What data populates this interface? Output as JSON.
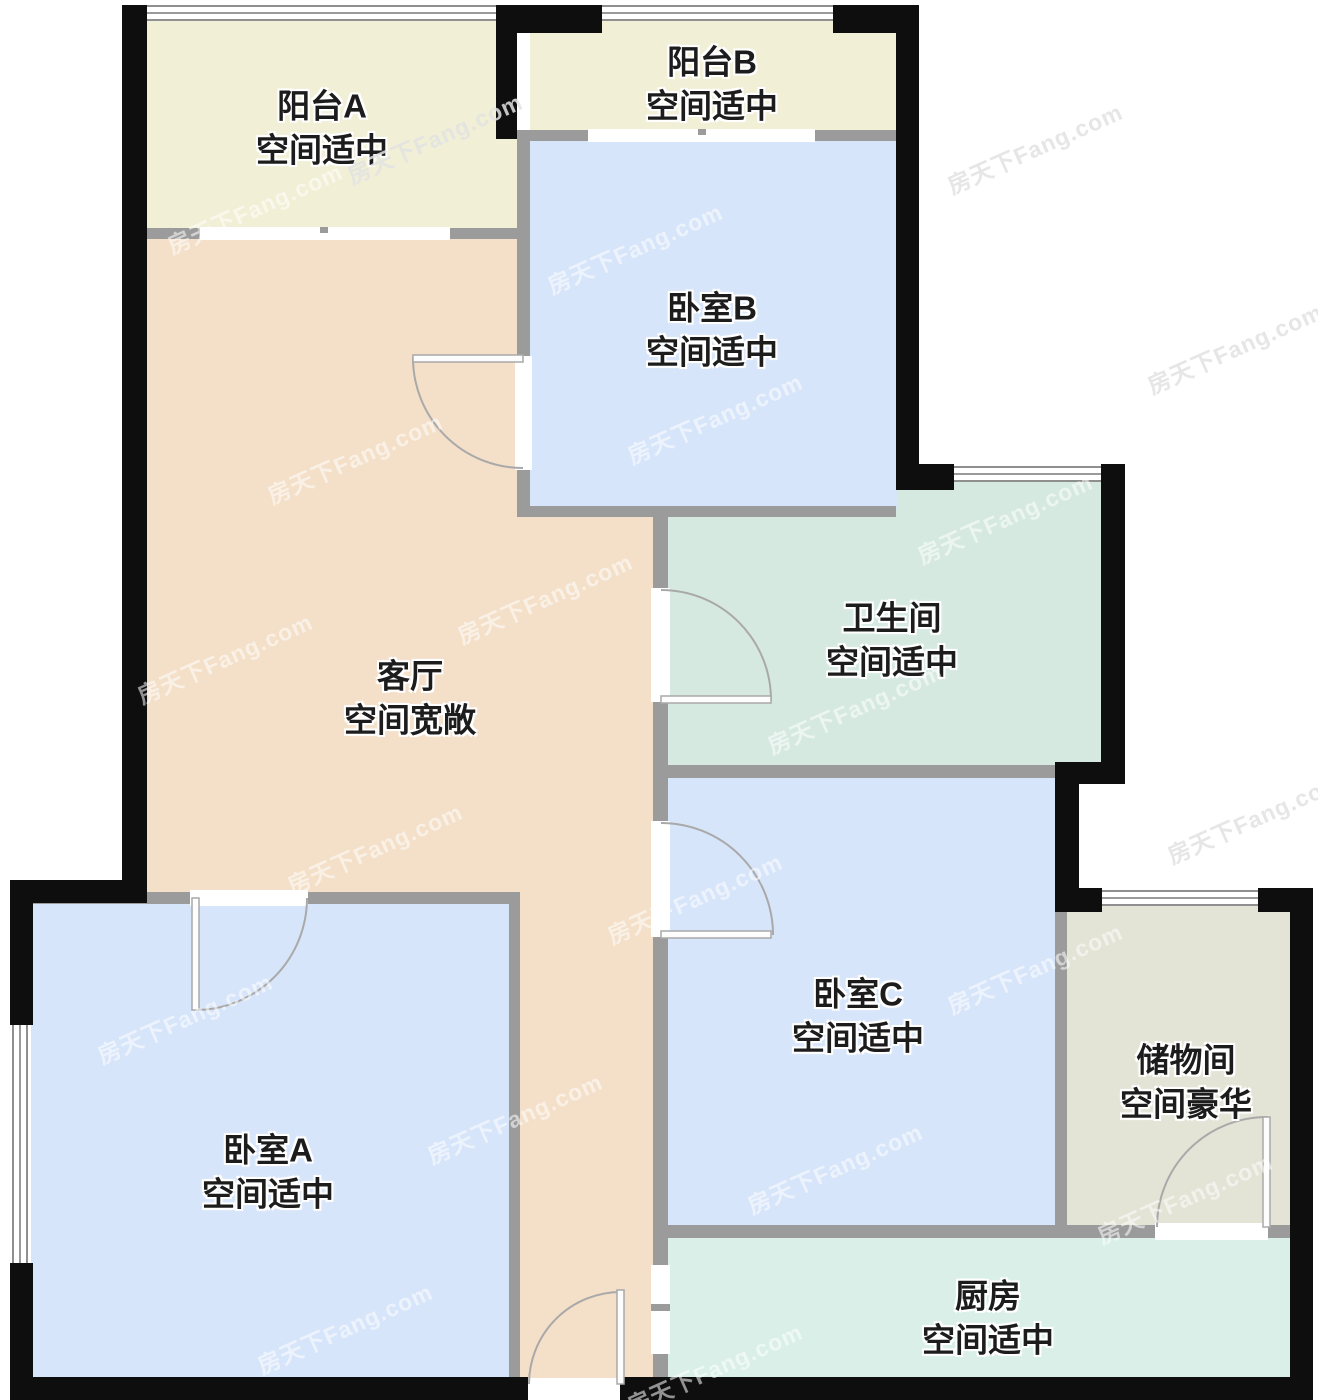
{
  "watermark": {
    "text": "房天下Fang.com"
  },
  "colors": {
    "exterior_wall": "#0e0e0e",
    "interior_wall": "#9b9b9b",
    "door_line": "#a9a9a9",
    "balcony_fill": "#f1efd5",
    "bedroom_fill": "#d7e5fa",
    "living_fill": "#f4dfc8",
    "bathroom_fill": "#d5e9e1",
    "storage_fill": "#e3e3d6",
    "kitchen_fill": "#d9efe8",
    "label_text": "#1c1c1c"
  },
  "rooms": [
    {
      "id": "balcony-a",
      "name": "阳台A",
      "descriptor": "空间适中",
      "color": "#f1efd5"
    },
    {
      "id": "balcony-b",
      "name": "阳台B",
      "descriptor": "空间适中",
      "color": "#f1efd5"
    },
    {
      "id": "bedroom-b",
      "name": "卧室B",
      "descriptor": "空间适中",
      "color": "#d7e5fa"
    },
    {
      "id": "living-room",
      "name": "客厅",
      "descriptor": "空间宽敞",
      "color": "#f4dfc8"
    },
    {
      "id": "bathroom",
      "name": "卫生间",
      "descriptor": "空间适中",
      "color": "#d5e9e1"
    },
    {
      "id": "bedroom-c",
      "name": "卧室C",
      "descriptor": "空间适中",
      "color": "#d7e5fa"
    },
    {
      "id": "storage",
      "name": "储物间",
      "descriptor": "空间豪华",
      "color": "#e3e3d6"
    },
    {
      "id": "bedroom-a",
      "name": "卧室A",
      "descriptor": "空间适中",
      "color": "#d7e5fa"
    },
    {
      "id": "kitchen",
      "name": "厨房",
      "descriptor": "空间适中",
      "color": "#d9efe8"
    }
  ]
}
